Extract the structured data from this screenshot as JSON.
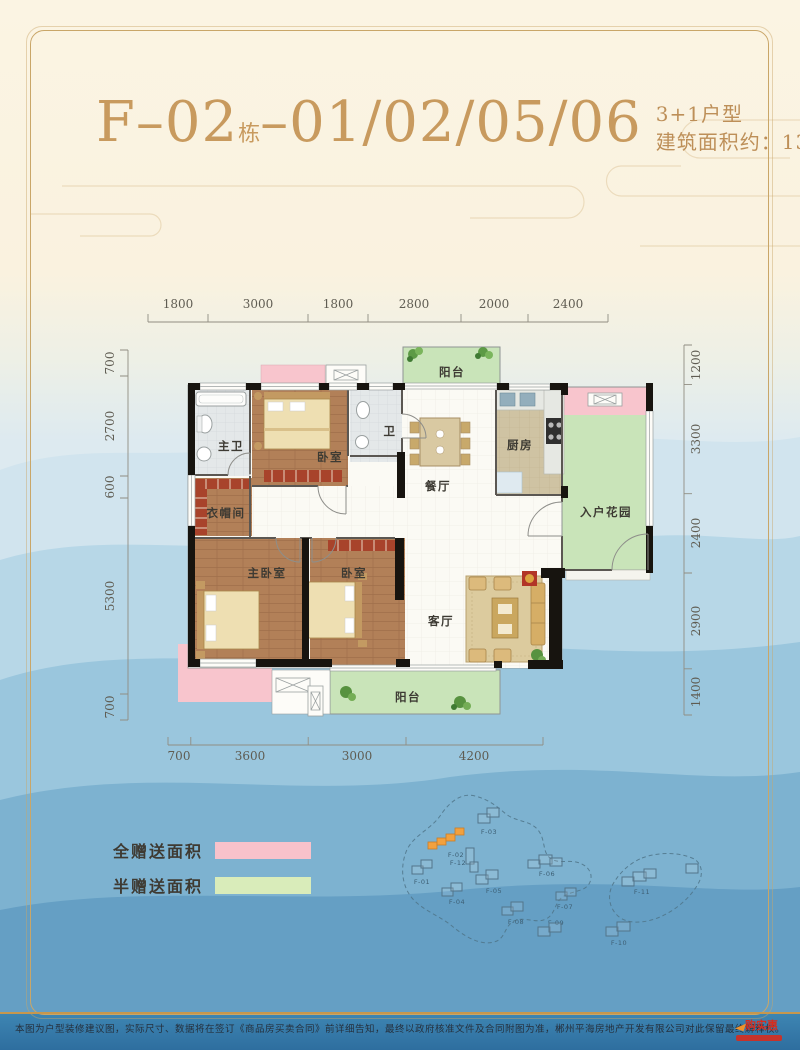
{
  "header": {
    "building": "F–02",
    "dong": "栋",
    "units": "–01/02/05/06",
    "unit_type": "3+1户型",
    "area": "建筑面积约：135.12m²"
  },
  "plan": {
    "rooms": {
      "balcony_top": "阳台",
      "master_bath": "主卫",
      "bedroom_top": "卧室",
      "bath": "卫",
      "dining": "餐厅",
      "kitchen": "厨房",
      "entry_garden": "入户花园",
      "cloakroom": "衣帽间",
      "master_bedroom": "主卧室",
      "bedroom_second": "卧室",
      "living": "客厅",
      "balcony_bottom": "阳台"
    },
    "dims_top": [
      "1800",
      "3000",
      "1800",
      "2800",
      "2000",
      "2400"
    ],
    "dims_left": [
      "700",
      "2700",
      "600",
      "5300",
      "700"
    ],
    "dims_right": [
      "1200",
      "3300",
      "2400",
      "2900",
      "1400"
    ],
    "dims_bottom": [
      "700",
      "3600",
      "3000",
      "4200"
    ]
  },
  "legend": {
    "full_gift_label": "全赠送面积",
    "half_gift_label": "半赠送面积",
    "full_gift_color": "#f8c2cb",
    "half_gift_color": "#d9ecba"
  },
  "siteplan": {
    "highlight": "F-02",
    "highlight_color": "#f2a13e",
    "buildings": [
      {
        "id": "F-01"
      },
      {
        "id": "F-02"
      },
      {
        "id": "F-03"
      },
      {
        "id": "F-04"
      },
      {
        "id": "F-05"
      },
      {
        "id": "F-06"
      },
      {
        "id": "F-07"
      },
      {
        "id": "F-08"
      },
      {
        "id": "F-09"
      },
      {
        "id": "F-10"
      },
      {
        "id": "F-11"
      },
      {
        "id": "F-12"
      }
    ]
  },
  "footer": {
    "disclaimer": "本图为户型装修建议图，实际尺寸、数据将在签订《商品房买卖合同》前详细告知，最终以政府核准文件及合同附图为准，郴州平海房地产开发有限公司对此保留最终解释权。",
    "watermark": "购实惠"
  }
}
